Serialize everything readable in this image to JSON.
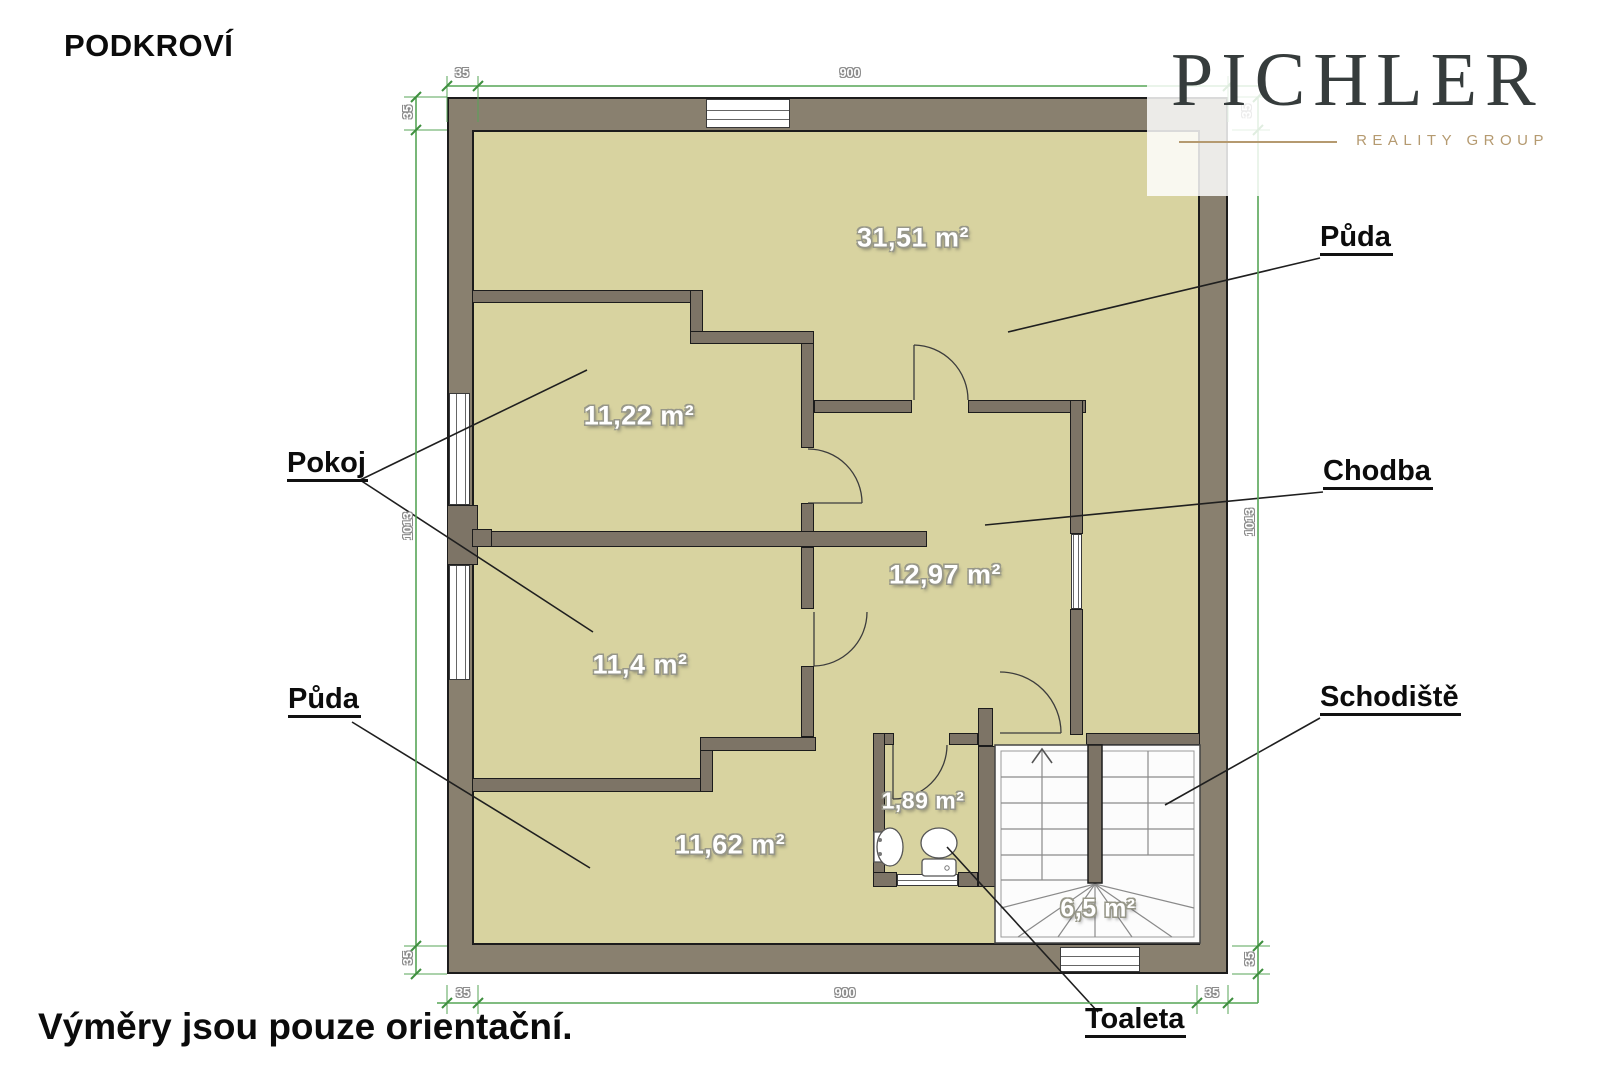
{
  "title": "PODKROVÍ",
  "footnote": "Výměry jsou pouze orientační.",
  "logo": {
    "brand": "PICHLER",
    "subtitle": "REALITY GROUP",
    "accent_color": "#b59a70",
    "text_color": "#363c3c"
  },
  "colors": {
    "wall": "#89806f",
    "interior_wall": "#7d7466",
    "floor": "#d8d3a0",
    "dimension_green": "#57a557",
    "outline": "#1c1c1c"
  },
  "rooms": [
    {
      "name": "Půda",
      "area": "31,51 m²"
    },
    {
      "name": "Pokoj",
      "area": "11,22 m²"
    },
    {
      "name": "Chodba",
      "area": "12,97 m²"
    },
    {
      "name": "Pokoj",
      "area": "11,4 m²"
    },
    {
      "name": "Půda",
      "area": "11,62 m²"
    },
    {
      "name": "Toaleta",
      "area": "1,89 m²"
    },
    {
      "name": "Schodiště",
      "area": "6,5 m²"
    }
  ],
  "callouts": {
    "puda_top": "Půda",
    "chodba": "Chodba",
    "schodiste": "Schodiště",
    "pokoj": "Pokoj",
    "puda_bottom": "Půda",
    "toaleta": "Toaleta"
  },
  "dimensions": {
    "top": [
      "35",
      "900",
      "35"
    ],
    "bottom": [
      "35",
      "900",
      "35"
    ],
    "left": [
      "35",
      "1013",
      "35"
    ],
    "right": [
      "1013",
      "35"
    ]
  }
}
